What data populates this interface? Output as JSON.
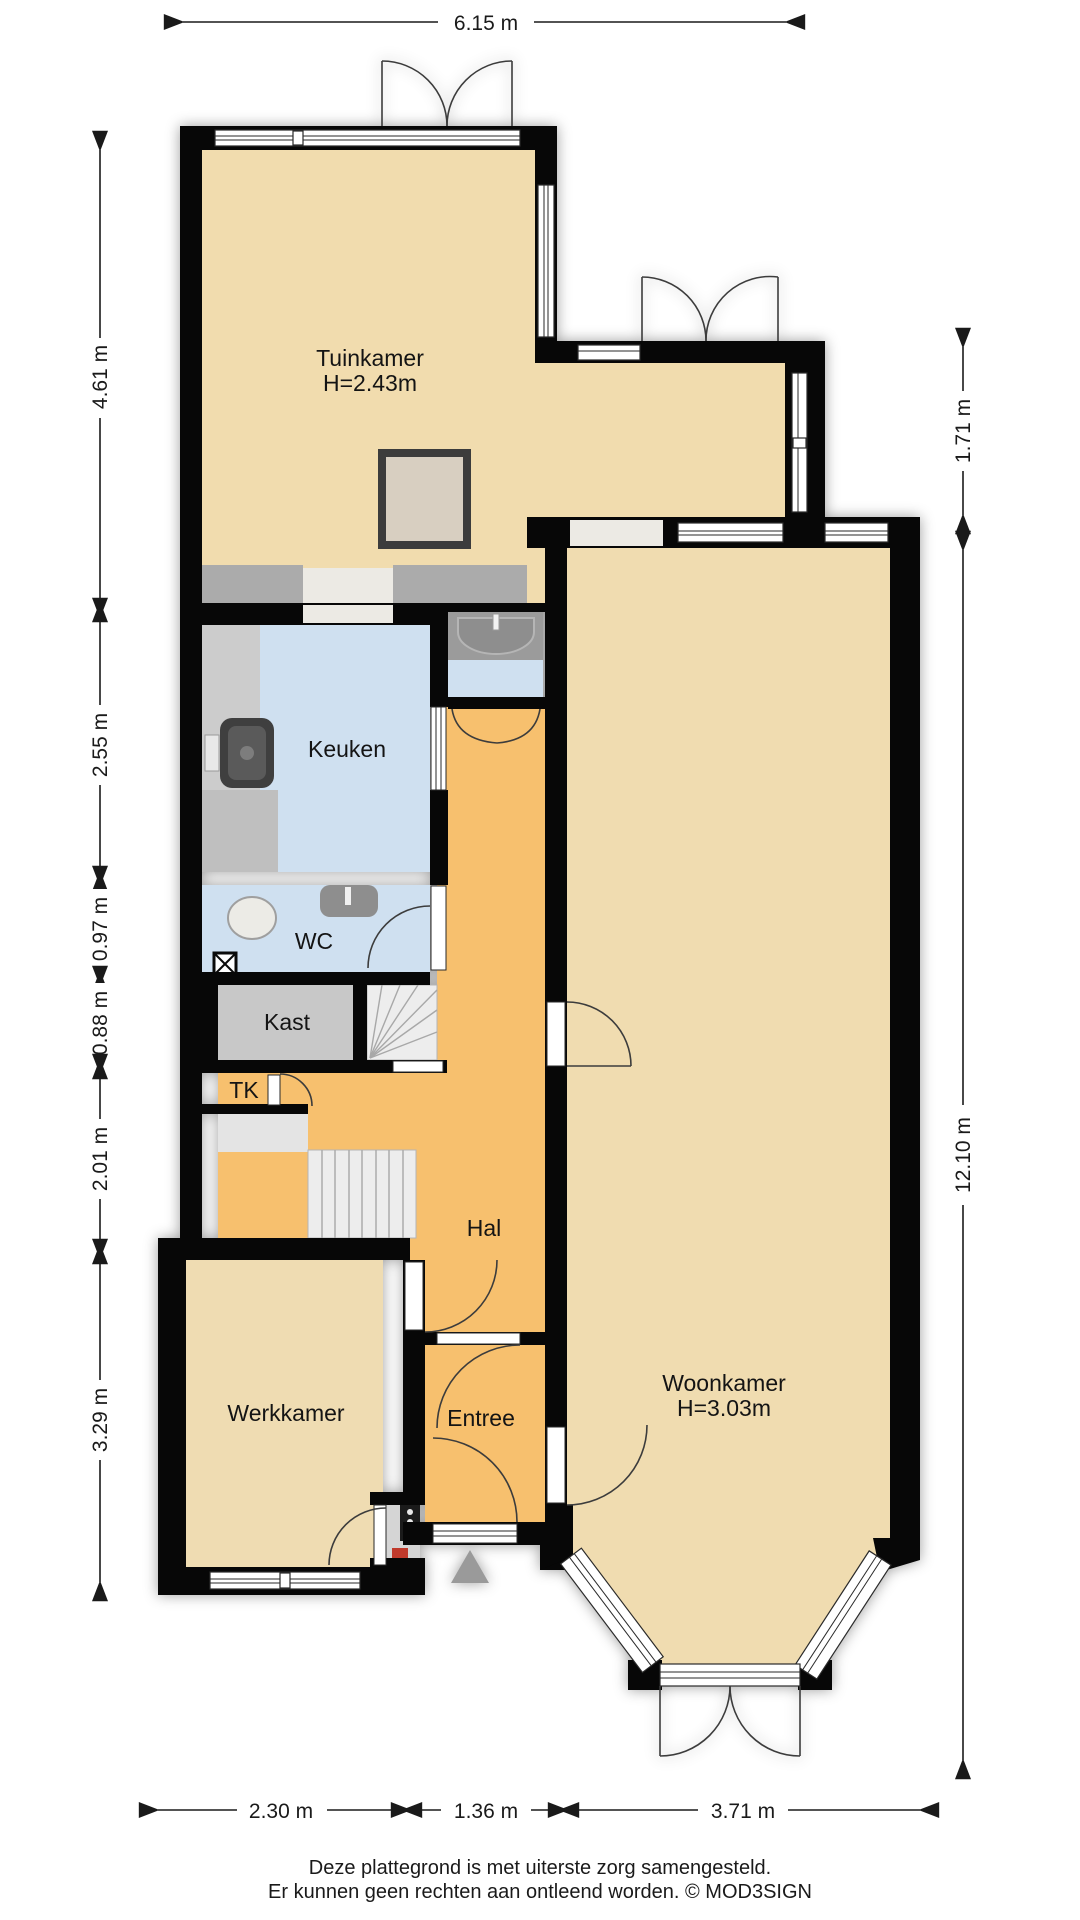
{
  "title": "Plattegrond begane grond",
  "dims": {
    "top": "6.15 m",
    "left": [
      "4.61 m",
      "2.55 m",
      "0.97 m",
      "0.88 m",
      "2.01 m",
      "3.29 m"
    ],
    "right": [
      "1.71 m",
      "12.10 m"
    ],
    "bottom": [
      "2.30 m",
      "1.36 m",
      "3.71 m"
    ]
  },
  "rooms": {
    "tuinkamer": {
      "name": "Tuinkamer",
      "height": "H=2.43m"
    },
    "keuken": {
      "name": "Keuken"
    },
    "wc": {
      "name": "WC"
    },
    "kast": {
      "name": "Kast"
    },
    "tk": {
      "name": "TK"
    },
    "hal": {
      "name": "Hal"
    },
    "werkkamer": {
      "name": "Werkkamer"
    },
    "entree": {
      "name": "Entree"
    },
    "woonkamer": {
      "name": "Woonkamer",
      "height": "H=3.03m"
    }
  },
  "footer": {
    "line1": "Deze plattegrond is met uiterste zorg samengesteld.",
    "line2": "Er kunnen geen rechten aan ontleend worden. © MOD3SIGN"
  },
  "colors": {
    "floor_living": "#f1dcae",
    "floor_hall": "#f7c06e",
    "floor_wet": "#cfe0f0",
    "floor_closet": "#c8c8c8",
    "wall": "#070707"
  }
}
